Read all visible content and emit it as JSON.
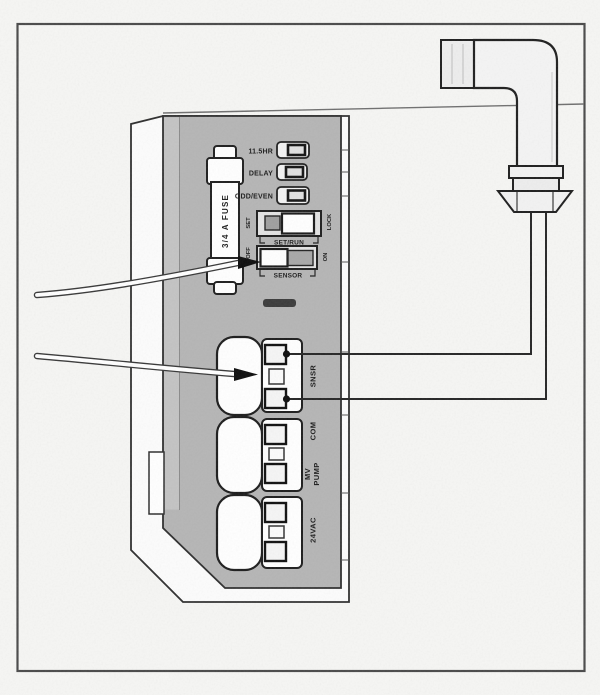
{
  "colors": {
    "background": "#f6f6f4",
    "panel_gray": "#b5b5b5",
    "outline": "#2b2b2b",
    "component_white": "#ffffff",
    "frame_border": "#4a4a4a"
  },
  "panel": {
    "fuse_label": "3/4 A FUSE",
    "jumpers": [
      {
        "label": "11.5HR"
      },
      {
        "label": "DELAY"
      },
      {
        "label": "ODD/EVEN"
      }
    ],
    "switches": [
      {
        "caption": "SET/RUN",
        "left_label": "SET",
        "right_label": "LOCK"
      },
      {
        "caption": "SENSOR",
        "left_label": "OFF",
        "right_label": "ON"
      }
    ],
    "terminals": [
      {
        "label": "SNSR"
      },
      {
        "label": "COM"
      },
      {
        "label": "MV",
        "label_line2": "PUMP"
      },
      {
        "label": "24VAC"
      }
    ]
  }
}
